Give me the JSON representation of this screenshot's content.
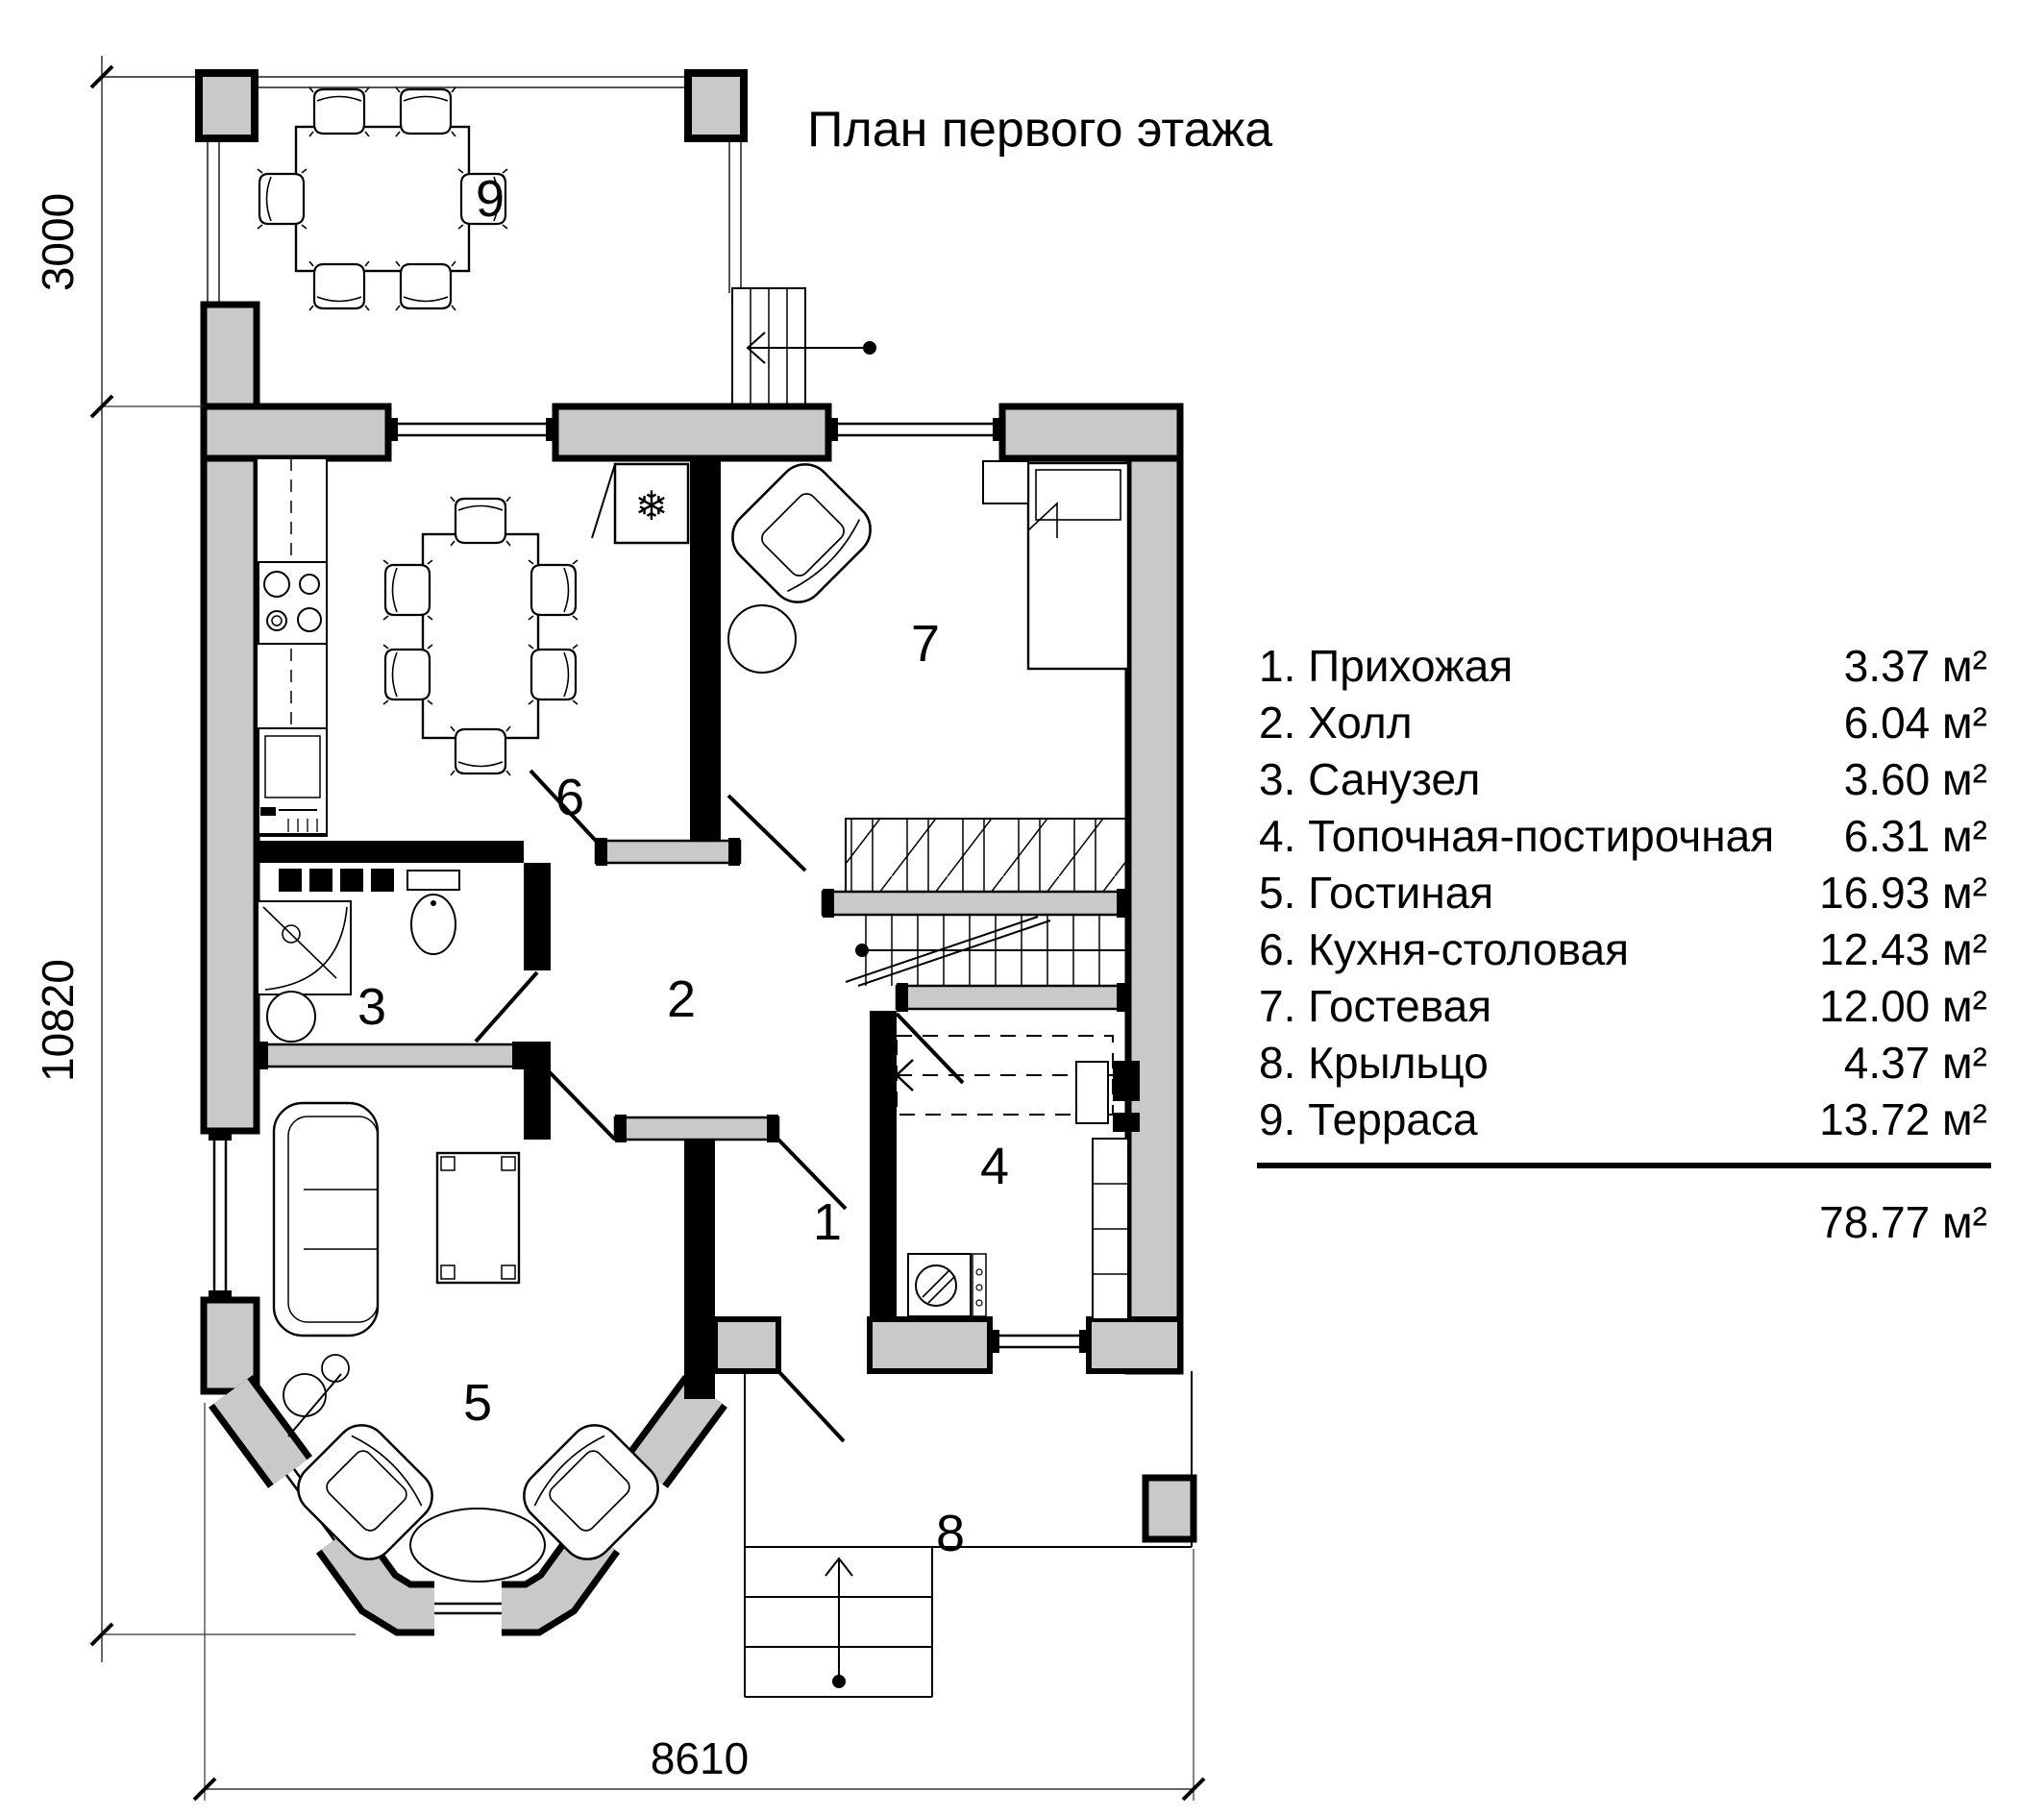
{
  "title": "План первого этажа",
  "legend": {
    "items": [
      {
        "label": "1. Прихожая",
        "area": "3.37 м²"
      },
      {
        "label": "2. Холл",
        "area": "6.04 м²"
      },
      {
        "label": "3. Санузел",
        "area": "3.60 м²"
      },
      {
        "label": "4. Топочная-постирочная",
        "area": "6.31 м²"
      },
      {
        "label": "5. Гостиная",
        "area": "16.93 м²"
      },
      {
        "label": "6. Кухня-столовая",
        "area": "12.43 м²"
      },
      {
        "label": "7. Гостевая",
        "area": "12.00 м²"
      },
      {
        "label": "8. Крыльцо",
        "area": "4.37 м²"
      },
      {
        "label": "9. Терраса",
        "area": "13.72 м²"
      }
    ],
    "total": "78.77 м²"
  },
  "dims": {
    "terrace_depth": "3000",
    "house_depth": "10820",
    "house_width": "8610"
  },
  "plan": {
    "room_labels": [
      "1",
      "2",
      "3",
      "4",
      "5",
      "6",
      "7",
      "8",
      "9"
    ],
    "fridge_icon": "❄"
  },
  "colors": {
    "wall_fill": "#c9c9c9",
    "line": "#000000"
  }
}
